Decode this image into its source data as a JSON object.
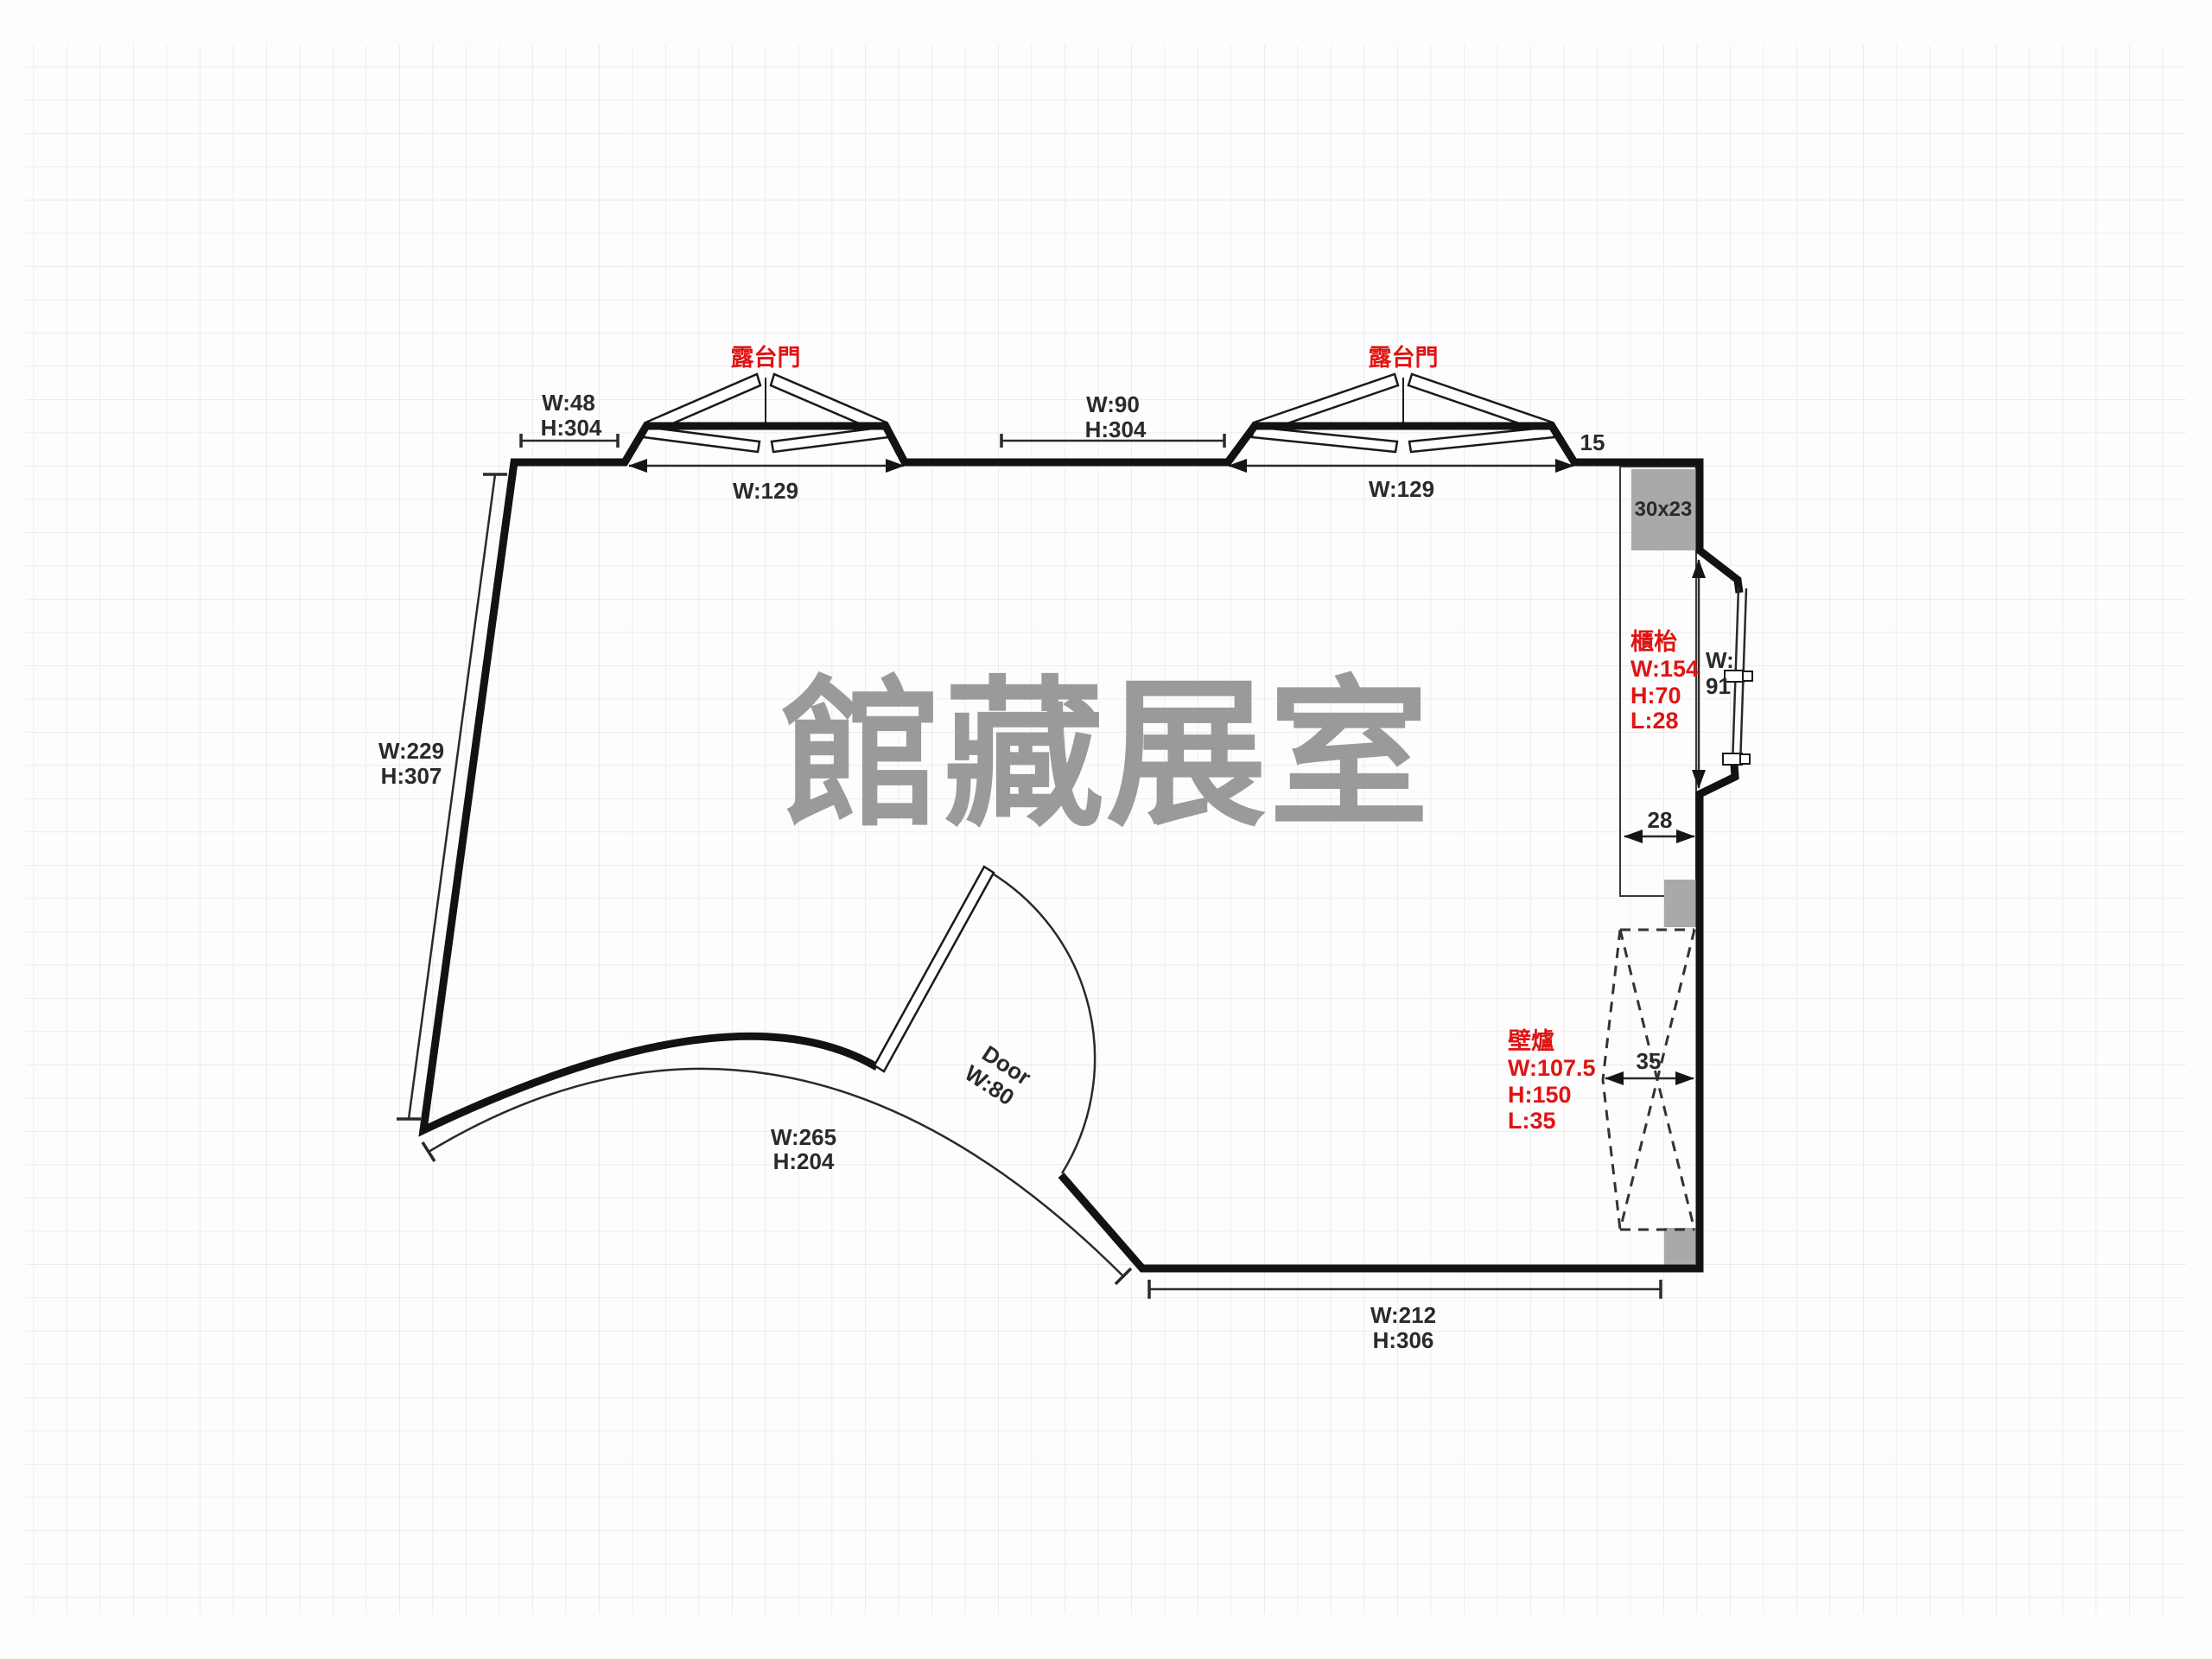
{
  "room": {
    "watermark": "館藏展室"
  },
  "colors": {
    "annotation_red": "#e01414",
    "wall_black": "#121212",
    "gray_block": "#a9a9a9",
    "watermark_gray": "#9a9a9a",
    "grid_line": "#e7e7e7"
  },
  "top": {
    "left_segment": {
      "w": "W:48",
      "h": "H:304"
    },
    "balcony_door_1": {
      "label": "露台門",
      "width": "W:129"
    },
    "mid_segment": {
      "w": "W:90",
      "h": "H:304"
    },
    "balcony_door_2": {
      "label": "露台門",
      "width": "W:129"
    },
    "right_segment": "15",
    "corner_block": "30x23"
  },
  "right": {
    "counter": {
      "label": "櫃枱",
      "w": "W:154",
      "h": "H:70",
      "l": "L:28",
      "depth": "28"
    },
    "window": {
      "w_prefix": "W:",
      "w_value": "91"
    },
    "fireplace": {
      "label": "壁爐",
      "w": "W:107.5",
      "h": "H:150",
      "l": "L:35",
      "depth": "35"
    }
  },
  "bottom_wall": {
    "w": "W:212",
    "h": "H:306"
  },
  "left_wall": {
    "w": "W:229",
    "h": "H:307"
  },
  "curved_wall": {
    "w": "W:265",
    "h": "H:204"
  },
  "entry_door": {
    "label": "Door",
    "width": "W:80"
  }
}
